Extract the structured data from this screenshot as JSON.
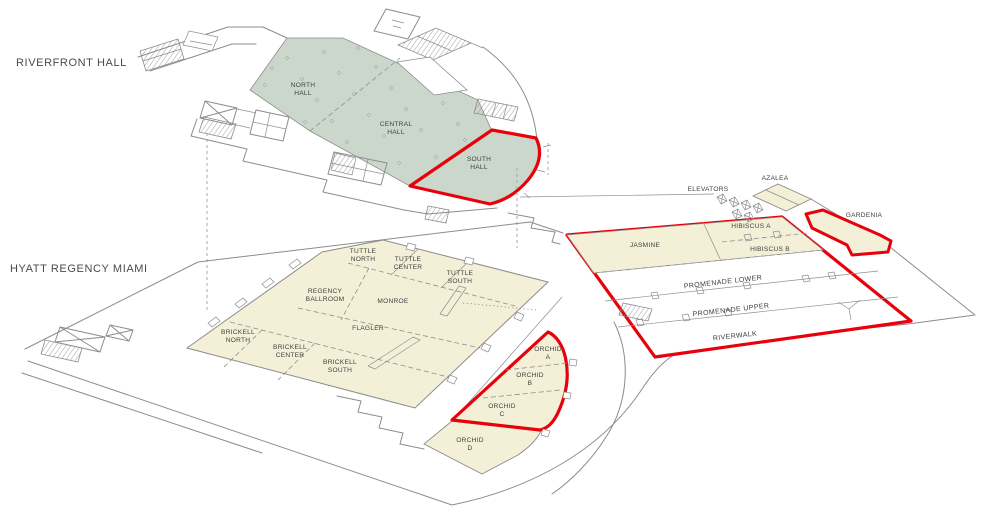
{
  "diagram": {
    "background": "#ffffff",
    "accent_red": "#e8000b",
    "hall_green": "#ccd7cc",
    "room_cream": "#f4f0d8",
    "line_gray": "#8c8c8c",
    "label_gray": "#4a4a4a"
  },
  "riverfront": {
    "title": "RIVERFRONT HALL",
    "rooms": {
      "north_hall": "NORTH\nHALL",
      "central_hall": "CENTRAL\nHALL",
      "south_hall": "SOUTH\nHALL"
    }
  },
  "hyatt": {
    "title": "HYATT REGENCY MIAMI",
    "rooms": {
      "tuttle_north": "TUTTLE\nNORTH",
      "tuttle_center": "TUTTLE\nCENTER",
      "tuttle_south": "TUTTLE\nSOUTH",
      "regency_ballroom": "REGENCY\nBALLROOM",
      "monroe": "MONROE",
      "flagler": "FLAGLER",
      "brickell_north": "BRICKELL\nNORTH",
      "brickell_center": "BRICKELL\nCENTER",
      "brickell_south": "BRICKELL\nSOUTH",
      "orchid_a": "ORCHID\nA",
      "orchid_b": "ORCHID\nB",
      "orchid_c": "ORCHID\nC",
      "orchid_d": "ORCHID\nD",
      "jasmine": "JASMINE",
      "hibiscus_a": "HIBISCUS A",
      "hibiscus_b": "HIBISCUS B",
      "promenade_lower": "PROMENADE LOWER",
      "promenade_upper": "PROMENADE UPPER",
      "riverwalk": "RIVERWALK",
      "elevators": "ELEVATORS",
      "azalea": "AZALEA",
      "gardenia": "GARDENIA"
    }
  }
}
